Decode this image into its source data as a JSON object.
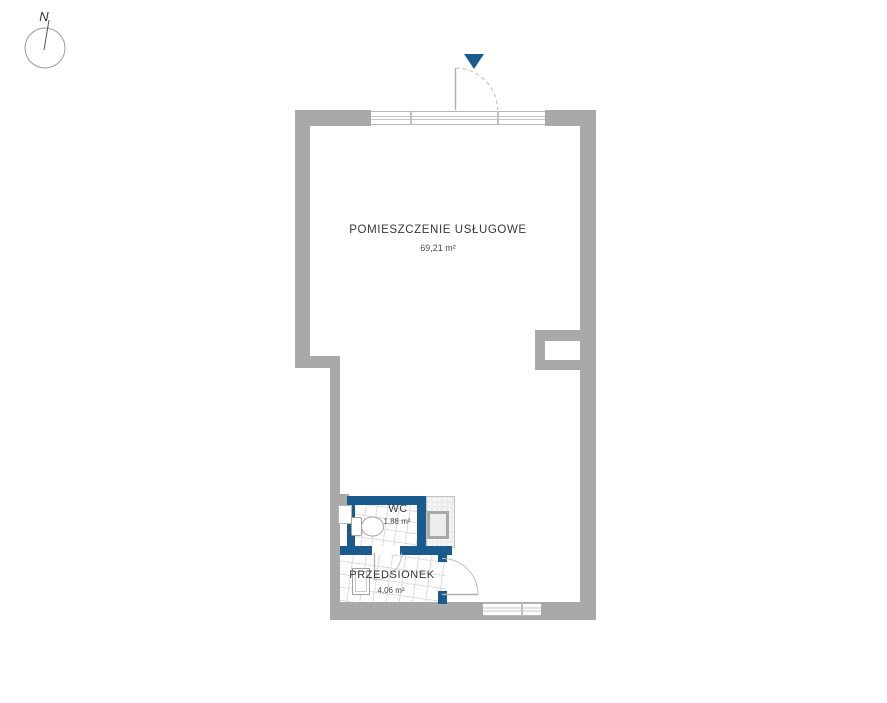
{
  "compass": {
    "north_label": "N"
  },
  "rooms": [
    {
      "id": "main",
      "name": "POMIESZCZENIE USŁUGOWE",
      "area": "69,21 m²"
    },
    {
      "id": "wc",
      "name": "WC",
      "area": "1,88 m²"
    },
    {
      "id": "vestibule",
      "name": "PRZEDSIONEK",
      "area": "4,06 m²"
    }
  ],
  "icons": {
    "entrance_marker": "triangle-down",
    "compass": "north-arrow-circle"
  },
  "colors": {
    "wall_gray": "#a9a9a9",
    "partition_blue": "#1a5a8c",
    "entrance_marker_blue": "#1a5a8c",
    "tile_line": "#dcdcdc",
    "fixture_outline": "#a3a3a3",
    "door_line": "#b8b8b8",
    "text_color": "#3a3a3a"
  }
}
